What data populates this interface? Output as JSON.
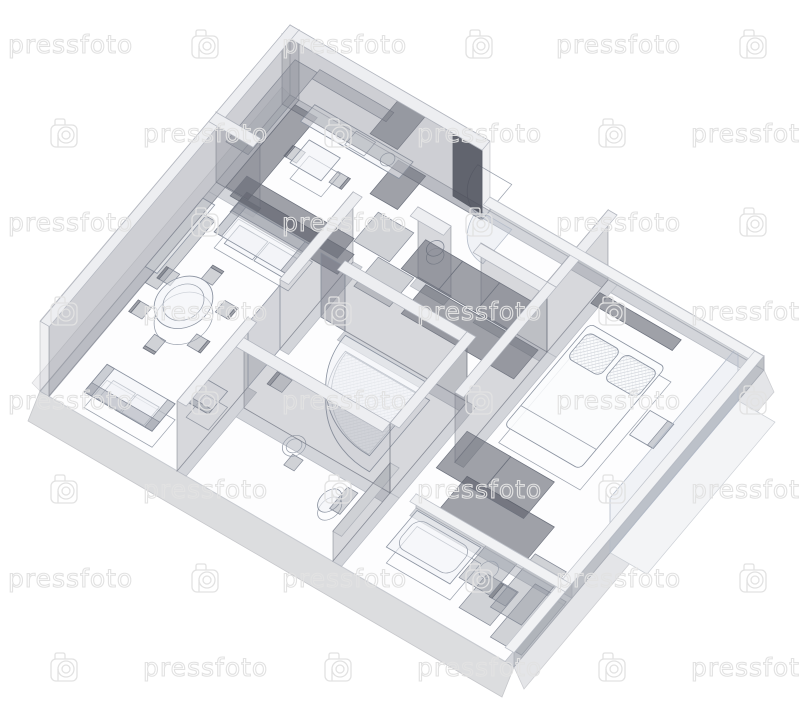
{
  "watermark": {
    "text": "pressfoto",
    "logo": "pressfoto-camera-logo",
    "color": "#e2e2e2"
  },
  "scene": {
    "background": "#ffffff",
    "line_color": "#9aa1ad",
    "wall_color": "#80848e",
    "slab_color": "#dcdddf",
    "dark_furniture_color": "#525660",
    "subject": "3d-wireframe-apartment-floor-plan"
  }
}
